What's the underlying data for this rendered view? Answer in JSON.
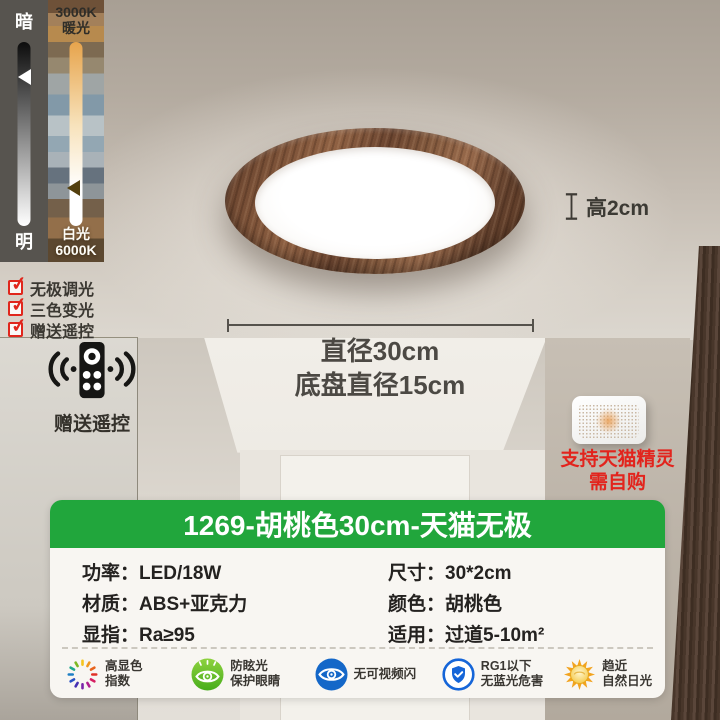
{
  "title": "1269-胡桃色30cm-天猫无极",
  "dimmer": {
    "dark_label": "暗",
    "bright_label": "明",
    "warm_k": "3000K",
    "warm_label": "暖光",
    "cool_label": "白光",
    "cool_k": "6000K"
  },
  "checklist": {
    "items": [
      {
        "label": "无极调光"
      },
      {
        "label": "三色变光"
      },
      {
        "label": "赠送遥控"
      }
    ]
  },
  "remote": {
    "label": "赠送遥控"
  },
  "annotations": {
    "height": "高2cm",
    "diameter": "直径30cm",
    "base_diameter": "底盘直径15cm"
  },
  "speaker": {
    "line1": "支持天猫精灵",
    "line2": "需自购"
  },
  "specs": {
    "left": [
      {
        "label": "功率：",
        "value": "LED/18W"
      },
      {
        "label": "材质：",
        "value": "ABS+亚克力"
      },
      {
        "label": "显指：",
        "value": "Ra≥95"
      }
    ],
    "right": [
      {
        "label": "尺寸：",
        "value": "30*2cm"
      },
      {
        "label": "颜色：",
        "value": "胡桃色"
      },
      {
        "label": "适用：",
        "value": "过道5-10m²"
      }
    ]
  },
  "badges": [
    {
      "icon": "color-wheel-icon",
      "line1": "高显色",
      "line2": "指数"
    },
    {
      "icon": "anti-glare-eye-icon",
      "line1": "防眩光",
      "line2": "保护眼睛"
    },
    {
      "icon": "no-flicker-eye-icon",
      "line1": "无可视频闪",
      "line2": ""
    },
    {
      "icon": "shield-check-icon",
      "line1": "RG1以下",
      "line2": "无蓝光危害"
    },
    {
      "icon": "sun-icon",
      "line1": "趋近",
      "line2": "自然日光"
    }
  ],
  "colors": {
    "banner_green": "#21a63c",
    "check_red": "#e0261c",
    "alert_red": "#e2241d",
    "badge_blue": "#1565d8",
    "badge_green": "#52b51e"
  }
}
